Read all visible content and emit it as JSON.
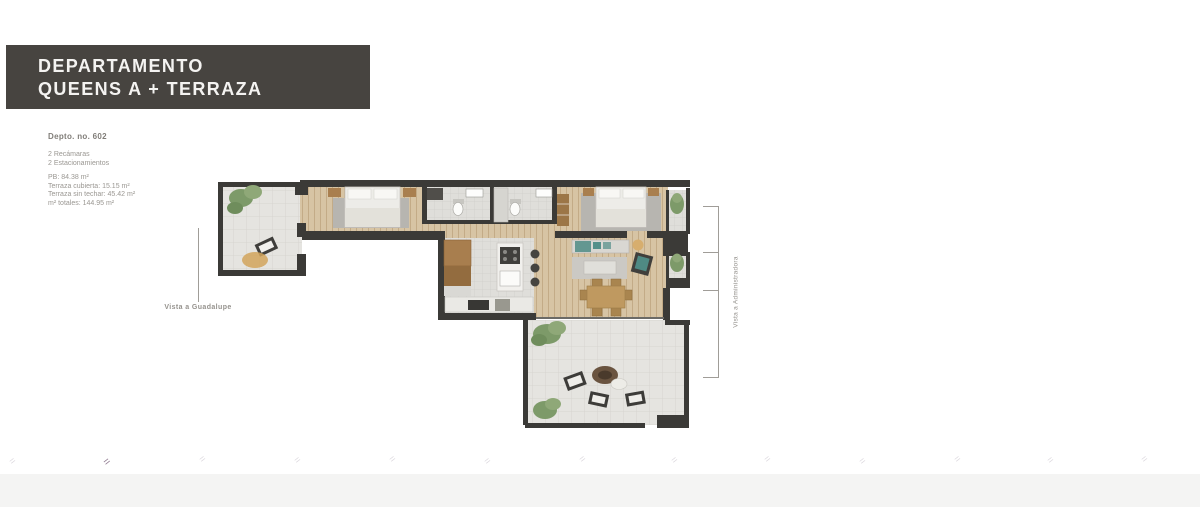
{
  "header": {
    "line1": "DEPARTAMENTO",
    "line2": "QUEENS A + TERRAZA"
  },
  "details": {
    "unit": "Depto. no. 602",
    "features": [
      "2 Recámaras",
      "2 Estacionamientos"
    ],
    "areas": [
      "PB: 84.38 m²",
      "Terraza cubierta: 15.15 m²",
      "Terraza sin techar: 45.42 m²",
      "m² totales: 144.95 m²"
    ]
  },
  "plan": {
    "label_left": "Vista a Guadalupe",
    "label_right": "Vista a Administradora"
  },
  "colors": {
    "header_bg": "#474440",
    "wall": "#3b3a37",
    "wood_floor": "#d7c4a4",
    "tile_floor": "#e5e4e0",
    "plant_green": "#7d9a69",
    "accent_teal": "#55908a",
    "rug_tan": "#d2a55c",
    "text_gray": "#95928d"
  }
}
